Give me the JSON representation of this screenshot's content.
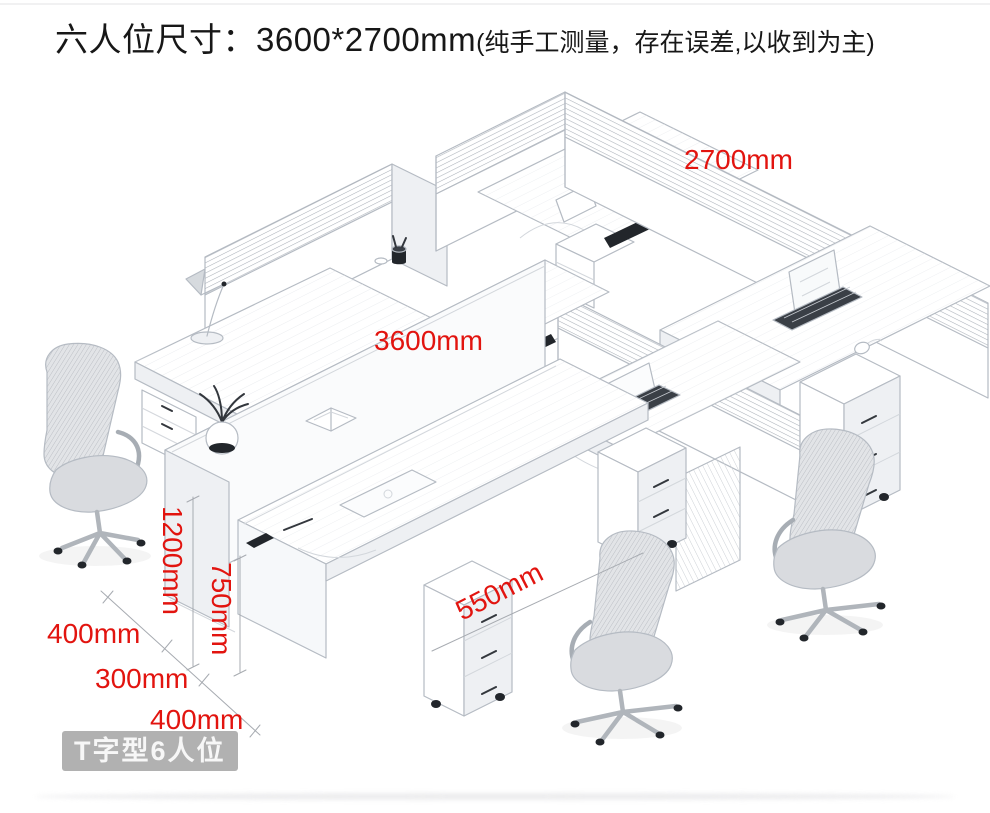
{
  "title": {
    "main": "六人位尺寸：3600*2700mm",
    "note": "(纯手工测量，存在误差,以收到为主)"
  },
  "annotations": {
    "total_width": "2700mm",
    "total_length": "3600mm",
    "screen_height": "1200mm",
    "desk_height": "750mm",
    "return_depth": "550mm",
    "depth_a": "400mm",
    "depth_b": "300mm",
    "depth_c": "400mm"
  },
  "badge": {
    "label": "T字型6人位"
  },
  "colors": {
    "dimension_red": "#e2140f",
    "sketch_line": "#b5bbc3",
    "badge_bg": "#a3a3a3",
    "title_color": "#171717"
  }
}
